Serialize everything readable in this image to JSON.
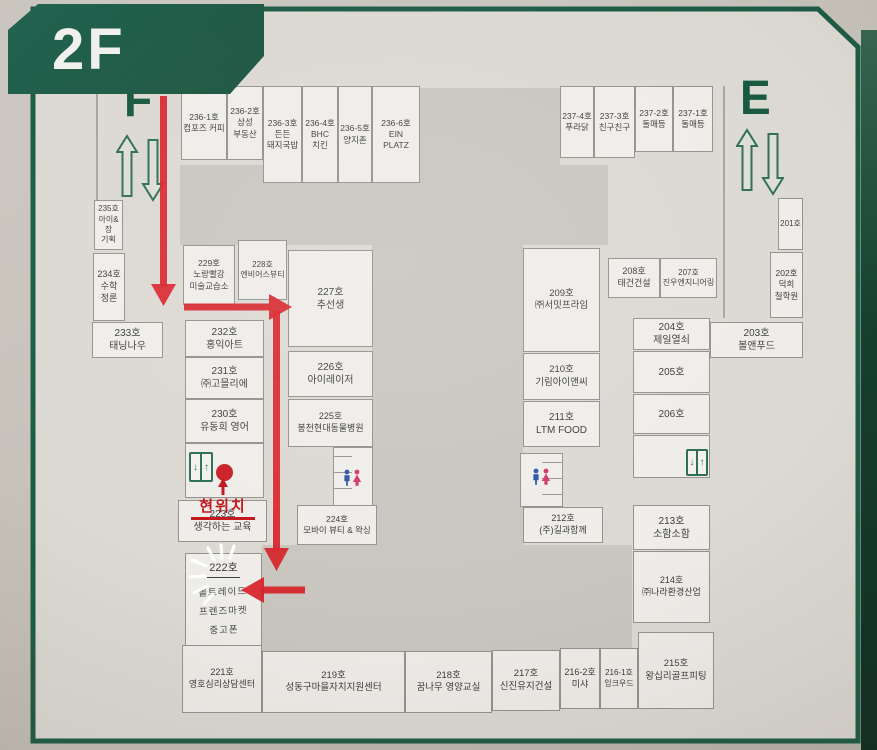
{
  "floor_label": "2F",
  "stairwells": {
    "left_label": "F",
    "right_label": "E"
  },
  "current_location": {
    "label": "현위치"
  },
  "icons": {
    "elevator_down": "↓",
    "elevator_up": "↑",
    "male_figure": "man-icon",
    "female_figure": "woman-icon"
  },
  "colors": {
    "board_green": "#1d5b45",
    "route_red": "#d42127",
    "toilet_male_blue": "#2d55a8",
    "toilet_female_pink": "#d23a68"
  },
  "rooms": {
    "n236_1": {
      "number": "236-1호",
      "name": "컴포즈 커피"
    },
    "n236_2": {
      "number": "236-2호",
      "name": "삼성\n부동산"
    },
    "n236_3": {
      "number": "236-3호",
      "name": "든든\n돼지국밥"
    },
    "n236_4": {
      "number": "236-4호",
      "name": "BHC\n치킨"
    },
    "n236_5": {
      "number": "236-5호",
      "name": "양지촌"
    },
    "n236_6": {
      "number": "236-6호",
      "name": "EIN\nPLATZ"
    },
    "n237_4": {
      "number": "237-4호",
      "name": "푸라닭"
    },
    "n237_3": {
      "number": "237-3호",
      "name": "친구친구"
    },
    "n237_2": {
      "number": "237-2호",
      "name": "돌매등"
    },
    "n237_1": {
      "number": "237-1호",
      "name": "돌매등"
    },
    "n235": {
      "number": "235호",
      "name": "아이&장\n기획"
    },
    "n234": {
      "number": "234호",
      "name": "수학\n정론"
    },
    "n233": {
      "number": "233호",
      "name": "태닝나우"
    },
    "n232": {
      "number": "232호",
      "name": "홍익아트"
    },
    "n231": {
      "number": "231호",
      "name": "㈜고믈리에"
    },
    "n230": {
      "number": "230호",
      "name": "유동희 영어"
    },
    "n229": {
      "number": "229호",
      "name": "노랑빨강\n미술교습소"
    },
    "n228": {
      "number": "228호",
      "name": "엔비어스뷰티"
    },
    "n227": {
      "number": "227호",
      "name": "추선생"
    },
    "n226": {
      "number": "226호",
      "name": "아이레이저"
    },
    "n225": {
      "number": "225호",
      "name": "봉천현대동물병원"
    },
    "n224": {
      "number": "224호",
      "name": "모바이 뷰티 & 왁싱"
    },
    "n223": {
      "number": "223호",
      "name": "생각하는 교육"
    },
    "n222": {
      "number": "222호",
      "name": "올트레이드\n프렌즈마켓\n중고폰"
    },
    "n221": {
      "number": "221호",
      "name": "영호심리상담센터"
    },
    "n219": {
      "number": "219호",
      "name": "성동구마을자치지원센터"
    },
    "n218": {
      "number": "218호",
      "name": "꿈나무 영양교실"
    },
    "n217": {
      "number": "217호",
      "name": "신진유지건설"
    },
    "n216_2": {
      "number": "216-2호",
      "name": "미샤"
    },
    "n216_1": {
      "number": "216-1호",
      "name": "잉크우드"
    },
    "n215": {
      "number": "215호",
      "name": "왕십리골프피팅"
    },
    "n214": {
      "number": "214호",
      "name": "㈜나라환경산업"
    },
    "n213": {
      "number": "213호",
      "name": "소함소함"
    },
    "n212": {
      "number": "212호",
      "name": "(주)길과함께"
    },
    "n211": {
      "number": "211호",
      "name": "LTM FOOD"
    },
    "n210": {
      "number": "210호",
      "name": "기림아이앤씨"
    },
    "n209": {
      "number": "209호",
      "name": "㈜서밋프라임"
    },
    "n208": {
      "number": "208호",
      "name": "태건건설"
    },
    "n207": {
      "number": "207호",
      "name": "진우엔지니어링"
    },
    "n206": {
      "number": "206호",
      "name": ""
    },
    "n205": {
      "number": "205호",
      "name": ""
    },
    "n204": {
      "number": "204호",
      "name": "제일열쇠"
    },
    "n203": {
      "number": "203호",
      "name": "볼앤푸드"
    },
    "n202": {
      "number": "202호",
      "name": "덕희\n철학원"
    },
    "n201": {
      "number": "201호",
      "name": ""
    }
  }
}
